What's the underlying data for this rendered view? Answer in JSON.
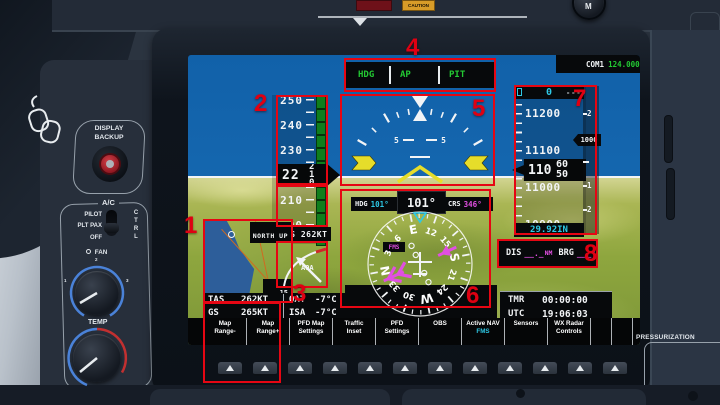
{
  "annotations": {
    "labels": [
      "1",
      "2",
      "3",
      "4",
      "5",
      "6",
      "7",
      "8"
    ]
  },
  "top_panel": {
    "caution_label": "CAUTION",
    "compass_knob": "M"
  },
  "left_panel": {
    "display_backup_line1": "DISPLAY",
    "display_backup_line2": "BACKUP",
    "ac_label": "A/C",
    "switch_pilot": "PILOT",
    "switch_plt_pax": "PLT PAX",
    "switch_off": "OFF",
    "ctrl_label": "CTRL",
    "fan_label": "FAN",
    "fan_ticks": [
      "1",
      "2",
      "3"
    ],
    "temp_label": "TEMP",
    "cb_light_label": "CB LIGHT"
  },
  "right_panel": {
    "pressurization_label": "PRESSURIZATION"
  },
  "pfd": {
    "com1": {
      "label": "COM1",
      "freq": "124.000"
    },
    "annunciator": {
      "hdg": "HDG",
      "ap": "AP",
      "pit": "PIT"
    },
    "speed": {
      "ticks": [
        "250",
        "240",
        "230",
        "220",
        "210",
        "200"
      ],
      "ias_hundreds": "22",
      "ias_rolling": [
        "2",
        "1",
        "0"
      ],
      "tas_box": "TAS 262KT"
    },
    "aoa": {
      "label": "AOA"
    },
    "attitude": {
      "pitch_left": "5",
      "pitch_right": "5"
    },
    "hsi": {
      "hdg_label": "HDG",
      "hdg_value": "101°",
      "heading_readout": "101°",
      "crs_label": "CRS",
      "crs_value": "346°",
      "nav_source": "FMS",
      "rose_labels": [
        "N",
        "3",
        "6",
        "E",
        "12",
        "15",
        "S",
        "21",
        "24",
        "W",
        "30",
        "33"
      ]
    },
    "inset_map": {
      "orientation_label": "NORTH UP",
      "range": "15"
    },
    "air_data": {
      "tas_label": "TAS",
      "tas_value": "262KT",
      "gs_label": "GS",
      "gs_value": "265KT",
      "oat_label": "OAT",
      "oat_value": "-7°C",
      "isa_label": "ISA",
      "isa_value": "-7°C"
    },
    "altitude": {
      "selected": "0",
      "ticks": [
        "11200",
        "11100",
        "11000",
        "10900"
      ],
      "alt_hundreds": "110",
      "alt_rolling": [
        "60",
        "50"
      ],
      "baro": "29.92IN",
      "vs_pointer": "1000",
      "vs_selected": "----",
      "vs_scale_labels": [
        "2",
        "1",
        "1",
        "2"
      ]
    },
    "nav_status": {
      "dis_label": "DIS",
      "dis_value": "__._",
      "dis_unit": "NM",
      "brg_label": "BRG",
      "brg_value": "___°"
    },
    "clocks": {
      "tmr_label": "TMR",
      "tmr_value": "00:00:00",
      "utc_label": "UTC",
      "utc_value": "19:06:03"
    },
    "softkeys": [
      {
        "l1": "Map",
        "l2": "Range-"
      },
      {
        "l1": "Map",
        "l2": "Range+"
      },
      {
        "l1": "PFD Map",
        "l2": "Settings"
      },
      {
        "l1": "Traffic",
        "l2": "Inset"
      },
      {
        "l1": "PFD",
        "l2": "Settings"
      },
      {
        "l1": "OBS",
        "l2": ""
      },
      {
        "l1": "Active NAV",
        "l2": "FMS"
      },
      {
        "l1": "Sensors",
        "l2": ""
      },
      {
        "l1": "WX Radar",
        "l2": "Controls"
      },
      {
        "l1": "",
        "l2": ""
      },
      {
        "l1": "",
        "l2": ""
      },
      {
        "l1": "",
        "l2": ""
      }
    ]
  },
  "colors": {
    "annotation_red": "#e60613",
    "pfd_green": "#23c933",
    "pfd_cyan": "#2ec9e6",
    "pfd_magenta": "#e14fe1",
    "sky_blue": "#1668b0",
    "terrain_green": "#93a53f",
    "caution_amber": "#d89c28"
  }
}
